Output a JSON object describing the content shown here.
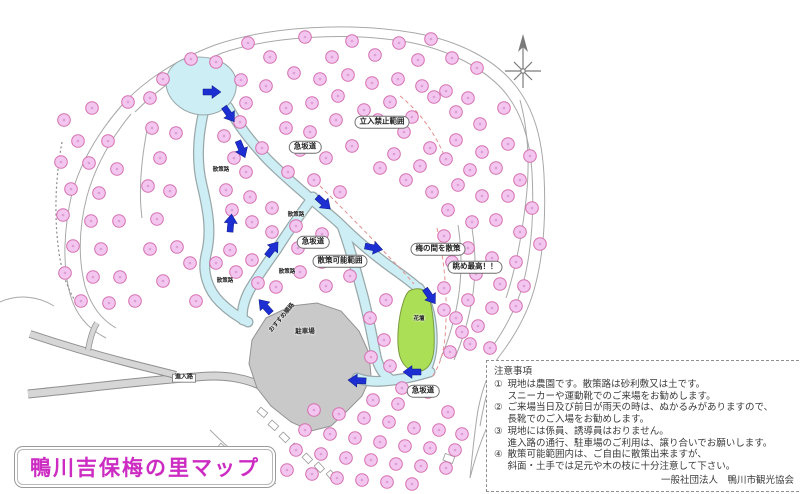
{
  "title": {
    "text": "鴨川吉保梅の里マップ"
  },
  "notes": {
    "heading": "注意事項",
    "items": [
      {
        "num": "①",
        "lines": [
          "現地は農園です。散策路は砂利敷又は土です。",
          "スニーカーや運動靴でのご来場をお勧めします。"
        ]
      },
      {
        "num": "②",
        "lines": [
          "ご来場当日及び前日が雨天の時は、ぬかるみがありますので、",
          "長靴でのご入場をお勧めします。"
        ]
      },
      {
        "num": "③",
        "lines": [
          "現地には係員、誘導員はおりません。",
          "進入路の通行、駐車場のご利用は、譲り合いでお願いします。"
        ]
      },
      {
        "num": "④",
        "lines": [
          "散策可能範囲内は、ご自由に散策出来ますが、",
          "斜面・土手では足元や木の枝に十分注意して下さい。"
        ]
      }
    ],
    "attribution": "一般社団法人　鴨川市観光協会"
  },
  "map": {
    "boxed_labels": [
      {
        "text": "立入禁止範囲",
        "x": 382,
        "y": 122
      },
      {
        "text": "急坂道",
        "x": 305,
        "y": 147
      },
      {
        "text": "急坂道",
        "x": 313,
        "y": 242
      },
      {
        "text": "散策可能範囲",
        "x": 340,
        "y": 261
      },
      {
        "text": "梅の間を散策",
        "x": 438,
        "y": 249
      },
      {
        "text": "眺め最高！！",
        "x": 475,
        "y": 267
      },
      {
        "text": "急坂道",
        "x": 423,
        "y": 391
      }
    ],
    "plain_labels": [
      {
        "text": "散策路",
        "x": 221,
        "y": 169,
        "size": 5.5,
        "rot": 0
      },
      {
        "text": "散策路",
        "x": 296,
        "y": 214,
        "size": 5.5,
        "rot": 0
      },
      {
        "text": "散策路",
        "x": 225,
        "y": 280,
        "size": 5.5,
        "rot": 0
      },
      {
        "text": "散策路",
        "x": 287,
        "y": 271,
        "size": 5.5,
        "rot": 0
      },
      {
        "text": "駐車場",
        "x": 305,
        "y": 330,
        "size": 6.5,
        "rot": 0
      },
      {
        "text": "花壇",
        "x": 419,
        "y": 318,
        "size": 5.5,
        "rot": 0
      },
      {
        "text": "おすすめ順路",
        "x": 281,
        "y": 317,
        "size": 6,
        "rot": -50
      },
      {
        "text": "進入路",
        "x": 184,
        "y": 378,
        "size": 6,
        "rot": 0,
        "style": "tag"
      }
    ],
    "arrows": [
      {
        "x": 203,
        "y": 92,
        "deg": 0
      },
      {
        "x": 224,
        "y": 107,
        "deg": 55
      },
      {
        "x": 238,
        "y": 141,
        "deg": 67
      },
      {
        "x": 317,
        "y": 197,
        "deg": 42
      },
      {
        "x": 230,
        "y": 232,
        "deg": -85
      },
      {
        "x": 267,
        "y": 256,
        "deg": -52
      },
      {
        "x": 365,
        "y": 246,
        "deg": 12
      },
      {
        "x": 425,
        "y": 289,
        "deg": 55
      },
      {
        "x": 421,
        "y": 372,
        "deg": 180
      },
      {
        "x": 366,
        "y": 381,
        "deg": 183
      },
      {
        "x": 271,
        "y": 313,
        "deg": -132
      }
    ],
    "flowers": [
      [
        150,
        98
      ],
      [
        128,
        102
      ],
      [
        163,
        79
      ],
      [
        191,
        59
      ],
      [
        216,
        62
      ],
      [
        248,
        43
      ],
      [
        270,
        57
      ],
      [
        305,
        37
      ],
      [
        332,
        57
      ],
      [
        352,
        41
      ],
      [
        375,
        55
      ],
      [
        399,
        43
      ],
      [
        418,
        60
      ],
      [
        431,
        39
      ],
      [
        452,
        58
      ],
      [
        477,
        68
      ],
      [
        241,
        80
      ],
      [
        266,
        86
      ],
      [
        294,
        73
      ],
      [
        320,
        79
      ],
      [
        348,
        75
      ],
      [
        372,
        83
      ],
      [
        398,
        79
      ],
      [
        422,
        86
      ],
      [
        446,
        91
      ],
      [
        468,
        98
      ],
      [
        246,
        103
      ],
      [
        286,
        108
      ],
      [
        312,
        103
      ],
      [
        338,
        96
      ],
      [
        364,
        110
      ],
      [
        390,
        102
      ],
      [
        412,
        117
      ],
      [
        434,
        97
      ],
      [
        456,
        112
      ],
      [
        480,
        124
      ],
      [
        504,
        108
      ],
      [
        92,
        108
      ],
      [
        64,
        120
      ],
      [
        78,
        141
      ],
      [
        108,
        141
      ],
      [
        61,
        162
      ],
      [
        89,
        163
      ],
      [
        117,
        169
      ],
      [
        71,
        189
      ],
      [
        99,
        193
      ],
      [
        63,
        215
      ],
      [
        91,
        221
      ],
      [
        119,
        221
      ],
      [
        73,
        246
      ],
      [
        101,
        249
      ],
      [
        65,
        273
      ],
      [
        93,
        277
      ],
      [
        120,
        277
      ],
      [
        81,
        301
      ],
      [
        109,
        303
      ],
      [
        135,
        301
      ],
      [
        152,
        128
      ],
      [
        176,
        133
      ],
      [
        160,
        158
      ],
      [
        148,
        186
      ],
      [
        170,
        191
      ],
      [
        157,
        219
      ],
      [
        177,
        247
      ],
      [
        150,
        249
      ],
      [
        163,
        281
      ],
      [
        190,
        263
      ],
      [
        196,
        301
      ],
      [
        240,
        122
      ],
      [
        224,
        136
      ],
      [
        262,
        148
      ],
      [
        234,
        158
      ],
      [
        246,
        172
      ],
      [
        226,
        190
      ],
      [
        250,
        197
      ],
      [
        232,
        210
      ],
      [
        252,
        222
      ],
      [
        230,
        250
      ],
      [
        252,
        260
      ],
      [
        236,
        272
      ],
      [
        258,
        283
      ],
      [
        216,
        263
      ],
      [
        286,
        128
      ],
      [
        310,
        132
      ],
      [
        336,
        120
      ],
      [
        300,
        150
      ],
      [
        326,
        158
      ],
      [
        352,
        146
      ],
      [
        288,
        172
      ],
      [
        314,
        180
      ],
      [
        340,
        192
      ],
      [
        272,
        208
      ],
      [
        296,
        226
      ],
      [
        322,
        234
      ],
      [
        272,
        232
      ],
      [
        298,
        248
      ],
      [
        322,
        262
      ],
      [
        300,
        272
      ],
      [
        276,
        287
      ],
      [
        326,
        286
      ],
      [
        350,
        276
      ],
      [
        378,
        120
      ],
      [
        404,
        132
      ],
      [
        430,
        148
      ],
      [
        456,
        140
      ],
      [
        482,
        152
      ],
      [
        508,
        144
      ],
      [
        530,
        156
      ],
      [
        394,
        154
      ],
      [
        420,
        166
      ],
      [
        446,
        159
      ],
      [
        470,
        170
      ],
      [
        496,
        168
      ],
      [
        520,
        180
      ],
      [
        380,
        168
      ],
      [
        406,
        180
      ],
      [
        432,
        192
      ],
      [
        458,
        185
      ],
      [
        482,
        196
      ],
      [
        508,
        196
      ],
      [
        532,
        208
      ],
      [
        448,
        210
      ],
      [
        472,
        222
      ],
      [
        496,
        220
      ],
      [
        520,
        232
      ],
      [
        540,
        244
      ],
      [
        444,
        236
      ],
      [
        468,
        248
      ],
      [
        492,
        258
      ],
      [
        516,
        262
      ],
      [
        452,
        262
      ],
      [
        476,
        274
      ],
      [
        500,
        284
      ],
      [
        524,
        286
      ],
      [
        444,
        288
      ],
      [
        468,
        300
      ],
      [
        492,
        308
      ],
      [
        516,
        306
      ],
      [
        456,
        318
      ],
      [
        478,
        326
      ],
      [
        470,
        344
      ],
      [
        490,
        348
      ],
      [
        386,
        300
      ],
      [
        370,
        318
      ],
      [
        384,
        340
      ],
      [
        371,
        357
      ],
      [
        390,
        366
      ],
      [
        444,
        310
      ],
      [
        462,
        332
      ],
      [
        450,
        352
      ],
      [
        287,
        470
      ],
      [
        296,
        450
      ],
      [
        305,
        430
      ],
      [
        314,
        410
      ],
      [
        312,
        474
      ],
      [
        321,
        454
      ],
      [
        330,
        434
      ],
      [
        339,
        414
      ],
      [
        337,
        478
      ],
      [
        346,
        458
      ],
      [
        355,
        438
      ],
      [
        364,
        418
      ],
      [
        373,
        400
      ],
      [
        362,
        480
      ],
      [
        371,
        460
      ],
      [
        380,
        442
      ],
      [
        389,
        422
      ],
      [
        398,
        404
      ],
      [
        387,
        482
      ],
      [
        396,
        464
      ],
      [
        405,
        446
      ],
      [
        414,
        428
      ],
      [
        412,
        484
      ],
      [
        421,
        466
      ],
      [
        430,
        448
      ],
      [
        439,
        430
      ],
      [
        448,
        412
      ],
      [
        446,
        468
      ],
      [
        455,
        450
      ],
      [
        462,
        434
      ],
      [
        402,
        388
      ],
      [
        428,
        392
      ]
    ],
    "colors": {
      "flower_fill": "#f3c6f0",
      "flower_edge": "#d56fae",
      "flower_dot": "#dd9ed6",
      "path_fill": "#cdeef4",
      "path_edge": "#9aa8aa",
      "green_fill": "#abdf55",
      "green_edge": "#7d9a40",
      "parking_fill": "#c9c9c9",
      "road_fill": "#d6d6d6",
      "outline": "#9a9a9a",
      "arrow": "#1d2ed2",
      "accent_magenta": "#cc2cc2",
      "dashed_boundary": "#e58f8f"
    }
  }
}
